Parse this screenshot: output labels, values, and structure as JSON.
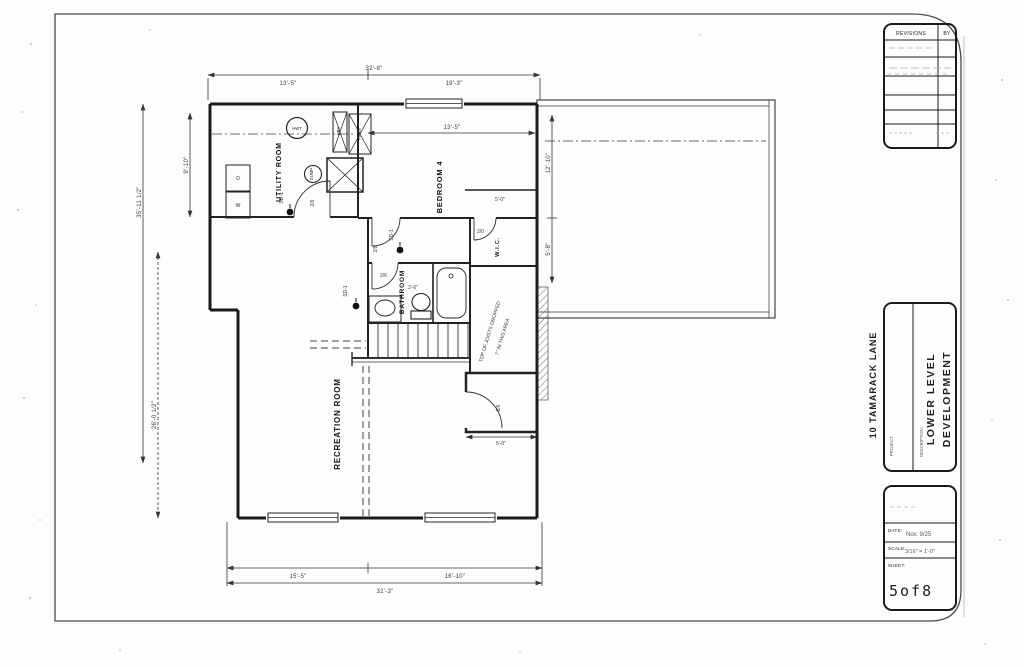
{
  "sheet": {
    "revisions_table": {
      "title": "REVISIONS",
      "by_col": "BY"
    },
    "project_block": {
      "project_label": "PROJECT:",
      "project_name": "10 TAMARACK LANE",
      "description_label": "DESCRIPTION:",
      "description_line1": "LOWER LEVEL",
      "description_line2": "DEVELOPMENT"
    },
    "info_block": {
      "date_label": "DATE:",
      "date_value": "Nov. 9/25",
      "scale_label": "SCALE:",
      "scale_value": "3/16\" = 1'-0\"",
      "sheet_label": "SHEET:",
      "sheet_number": "5of8"
    }
  },
  "plan": {
    "rooms": {
      "utility": "UTILITY ROOM",
      "bedroom4": "BEDROOM 4",
      "wic": "W.I.C.",
      "bathroom": "BATHROOM",
      "recreation": "RECREATION ROOM"
    },
    "equipment": {
      "hot_water_tank": "HWT",
      "sump": "SUMP",
      "furnace": "FURN",
      "hrv": "HRV",
      "dryer": "D",
      "washer": "W"
    },
    "smoke_detector_label": "SD-1",
    "doors": {
      "utility_door": "2/6",
      "bedroom_door": "2/8",
      "bathroom_door": "2/6",
      "wic_door": "2/0",
      "exterior_door": "2/6"
    },
    "notes": {
      "joists_line1": "TOP OF JOISTS DROPPED",
      "joists_line2": "7\" IN THIS AREA"
    },
    "dimensions": {
      "top_overall": "32'-8\"",
      "top_left": "13'-5\"",
      "top_right": "19'-3\"",
      "bottom_left": "15'-5\"",
      "bottom_right": "16'-10\"",
      "bottom_overall": "32'-3\"",
      "left_outer": "35'-11 1/2\"",
      "left_inner": "9'-10\"",
      "left_lower": "26'-0 1/2\"",
      "right_upper": "12'-10\"",
      "right_lower": "5'-8\"",
      "bedroom_width": "13'-5\"",
      "bedroom_closet": "5'-0\"",
      "bathroom_dim": "3'-6\"",
      "landing": "5'-0\""
    }
  }
}
